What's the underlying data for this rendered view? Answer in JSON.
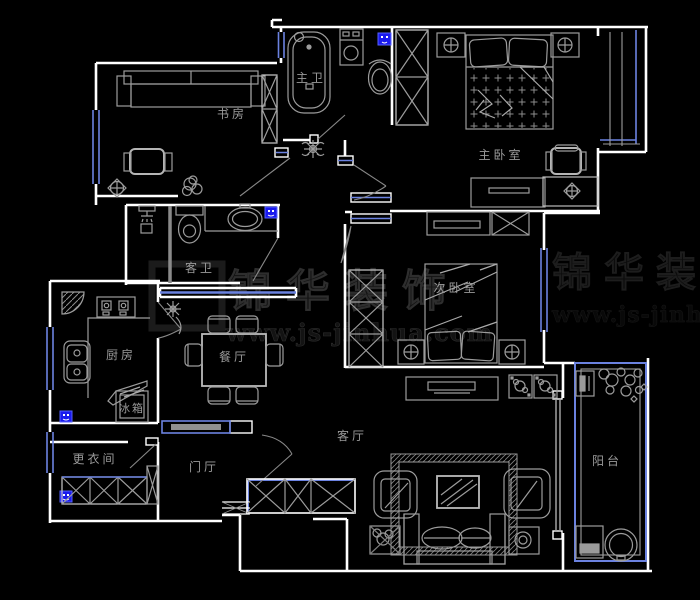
{
  "plan_title": "apartment-floor-plan",
  "colors": {
    "background": "#000000",
    "wall": "#ffffff",
    "furniture": "#9c9c9c",
    "furniture_bright": "#c8c8c8",
    "window_blue": "#6b82e0",
    "marker_blue": "#1a1aee",
    "label_gray": "#9a9a9a",
    "watermark_gray": "#1c1c1c"
  },
  "rooms": {
    "study": {
      "label": "书房"
    },
    "master_bath": {
      "label": "主卫"
    },
    "master_bedroom": {
      "label": "主卧室"
    },
    "guest_bath": {
      "label": "客卫"
    },
    "second_bedroom": {
      "label": "次卧室"
    },
    "kitchen": {
      "label": "厨房"
    },
    "dining": {
      "label": "餐厅"
    },
    "dressing": {
      "label": "更衣间"
    },
    "foyer": {
      "label": "门厅"
    },
    "living": {
      "label": "客厅"
    },
    "balcony": {
      "label": "阳台"
    }
  },
  "appliances": {
    "fridge": {
      "label": "冰箱"
    }
  },
  "watermark": {
    "brand": "锦华装饰",
    "url": "www.js-jinhua.com"
  }
}
